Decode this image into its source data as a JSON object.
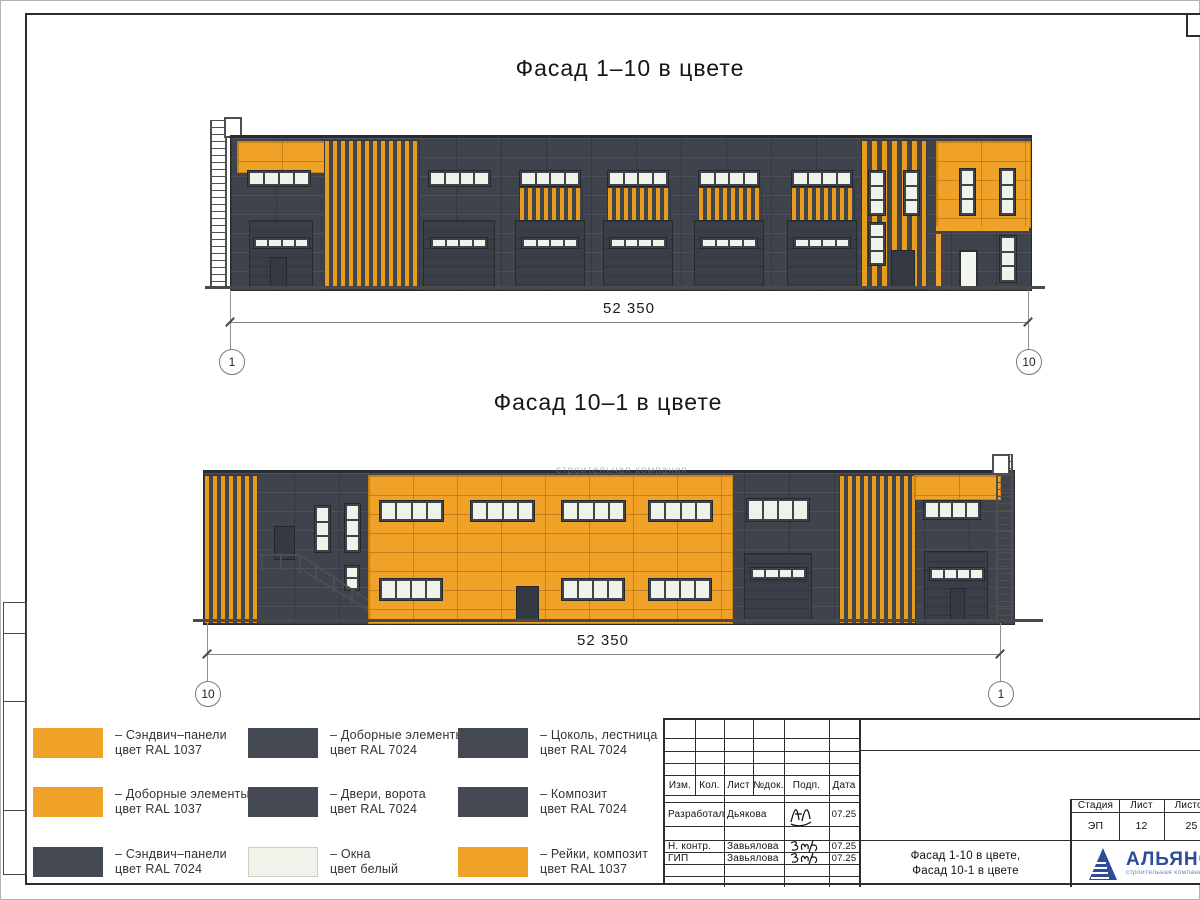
{
  "colors": {
    "ral1037_orange": "#F0A127",
    "ral7024_dark": "#41464F",
    "window_white": "#F0F3E9",
    "logo_blue": "#2F4C9B"
  },
  "facade_top": {
    "title": "Фасад 1–10 в цвете",
    "dimension": "52 350",
    "axis_left": "1",
    "axis_right": "10"
  },
  "facade_bottom": {
    "title": "Фасад 10–1 в цвете",
    "dimension": "52 350",
    "axis_left": "10",
    "axis_right": "1"
  },
  "watermark": "строительная компания",
  "legend": {
    "items": [
      {
        "swatch": "orange",
        "line1": "– Сэндвич–панели",
        "line2": "цвет RAL 1037"
      },
      {
        "swatch": "orange",
        "line1": "– Доборные элементы",
        "line2": "цвет RAL 1037"
      },
      {
        "swatch": "dark",
        "line1": "– Сэндвич–панели",
        "line2": "цвет RAL 7024"
      },
      {
        "swatch": "dark",
        "line1": "– Доборные элементы",
        "line2": "цвет RAL 7024"
      },
      {
        "swatch": "dark",
        "line1": "– Двери, ворота",
        "line2": "цвет RAL 7024"
      },
      {
        "swatch": "white",
        "line1": "– Окна",
        "line2": "цвет белый"
      },
      {
        "swatch": "dark",
        "line1": "– Цоколь, лестница",
        "line2": "цвет RAL 7024"
      },
      {
        "swatch": "dark",
        "line1": "– Композит",
        "line2": "цвет RAL 7024"
      },
      {
        "swatch": "orange",
        "line1": "– Рейки, композит",
        "line2": "цвет RAL 1037"
      }
    ]
  },
  "titleblock": {
    "header_cols": [
      "Изм.",
      "Кол.",
      "Лист",
      "№док.",
      "Подп.",
      "Дата"
    ],
    "rows": [
      {
        "role": "Разработал",
        "name": "Дьякова",
        "date": "07.25"
      },
      {
        "role": "Н. контр.",
        "name": "Завьялова",
        "date": "07.25"
      },
      {
        "role": "ГИП",
        "name": "Завьялова",
        "date": "07.25"
      }
    ],
    "stage_label": "Стадия",
    "sheet_label": "Лист",
    "sheets_label": "Листов",
    "stage": "ЭП",
    "sheet": "12",
    "sheets": "25",
    "doc_title_line1": "Фасад 1-10 в цвете,",
    "doc_title_line2": "Фасад 10-1 в цвете",
    "logo_text": "АЛЬЯНС",
    "logo_sub": "строительная компания"
  }
}
